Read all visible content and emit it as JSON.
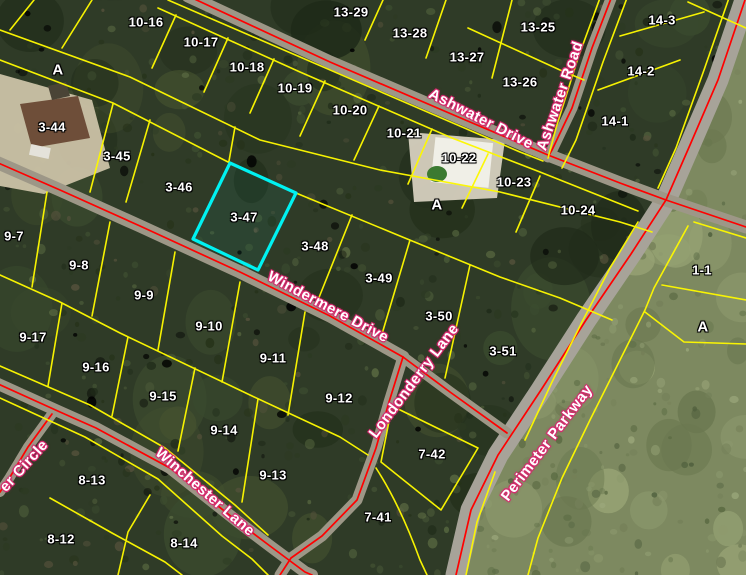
{
  "map_view": {
    "description": "aerial-parcel-map",
    "highlighted_parcel": {
      "id": "3-47"
    },
    "colors": {
      "parcel_line": "#fdf800",
      "highlight_outline": "#00f2f2",
      "road_centerline": "#ff0000",
      "parcel_label_text": "#ffffff",
      "parcel_label_halo": "#000000",
      "street_label_text": "#ffffff",
      "street_label_halo": "#d62a6e",
      "forest_base": "#2f3b27",
      "clearing_base": "#7d8960",
      "road_surface": "#9d9787"
    },
    "parcel_labels": [
      {
        "id": "10-15",
        "x": 105,
        "y": -6
      },
      {
        "id": "10-16",
        "x": 146,
        "y": 22
      },
      {
        "id": "10-17",
        "x": 201,
        "y": 42
      },
      {
        "id": "10-18",
        "x": 247,
        "y": 67
      },
      {
        "id": "10-19",
        "x": 295,
        "y": 88
      },
      {
        "id": "10-20",
        "x": 350,
        "y": 110
      },
      {
        "id": "10-21",
        "x": 404,
        "y": 133
      },
      {
        "id": "10-22",
        "x": 459,
        "y": 158
      },
      {
        "id": "10-23",
        "x": 514,
        "y": 182
      },
      {
        "id": "10-24",
        "x": 578,
        "y": 210
      },
      {
        "id": "13-29",
        "x": 351,
        "y": 12
      },
      {
        "id": "13-28",
        "x": 410,
        "y": 33
      },
      {
        "id": "13-27",
        "x": 467,
        "y": 57
      },
      {
        "id": "13-25",
        "x": 538,
        "y": 27
      },
      {
        "id": "13-26",
        "x": 520,
        "y": 82
      },
      {
        "id": "14-3",
        "x": 662,
        "y": 20
      },
      {
        "id": "14-2",
        "x": 641,
        "y": 71
      },
      {
        "id": "14-1",
        "x": 615,
        "y": 121
      },
      {
        "id": "3-44",
        "x": 52,
        "y": 127
      },
      {
        "id": "3-45",
        "x": 117,
        "y": 156
      },
      {
        "id": "3-46",
        "x": 179,
        "y": 187
      },
      {
        "id": "3-47",
        "x": 244,
        "y": 217
      },
      {
        "id": "3-48",
        "x": 315,
        "y": 246
      },
      {
        "id": "3-49",
        "x": 379,
        "y": 278
      },
      {
        "id": "3-50",
        "x": 439,
        "y": 316
      },
      {
        "id": "3-51",
        "x": 503,
        "y": 351
      },
      {
        "id": "9-7",
        "x": 14,
        "y": 236
      },
      {
        "id": "9-8",
        "x": 79,
        "y": 265
      },
      {
        "id": "9-9",
        "x": 144,
        "y": 295
      },
      {
        "id": "9-10",
        "x": 209,
        "y": 326
      },
      {
        "id": "9-11",
        "x": 273,
        "y": 358
      },
      {
        "id": "9-12",
        "x": 339,
        "y": 398
      },
      {
        "id": "9-17",
        "x": 33,
        "y": 337
      },
      {
        "id": "9-16",
        "x": 96,
        "y": 367
      },
      {
        "id": "9-15",
        "x": 163,
        "y": 396
      },
      {
        "id": "9-14",
        "x": 224,
        "y": 430
      },
      {
        "id": "9-13",
        "x": 273,
        "y": 475
      },
      {
        "id": "8-13",
        "x": 92,
        "y": 480
      },
      {
        "id": "8-12",
        "x": 61,
        "y": 539
      },
      {
        "id": "8-14",
        "x": 184,
        "y": 543
      },
      {
        "id": "7-42",
        "x": 432,
        "y": 454
      },
      {
        "id": "7-41",
        "x": 378,
        "y": 517
      },
      {
        "id": "1-1",
        "x": 702,
        "y": 270
      }
    ],
    "block_labels": [
      {
        "text": "A",
        "x": 58,
        "y": 70
      },
      {
        "text": "A",
        "x": 437,
        "y": 205
      },
      {
        "text": "A",
        "x": 703,
        "y": 327
      }
    ],
    "street_labels": [
      {
        "name": "Ashwater Drive",
        "x": 481,
        "y": 119,
        "angle": 27
      },
      {
        "name": "Ashwater Road",
        "x": 560,
        "y": 96,
        "angle": -71
      },
      {
        "name": "Windermere Drive",
        "x": 328,
        "y": 307,
        "angle": 28
      },
      {
        "name": "Londonderry Lane",
        "x": 414,
        "y": 381,
        "angle": -53
      },
      {
        "name": "Winchester Lane",
        "x": 205,
        "y": 492,
        "angle": 41
      },
      {
        "name": "Perimeter Parkway",
        "x": 547,
        "y": 443,
        "angle": -53
      },
      {
        "name": "er Circle",
        "x": 24,
        "y": 466,
        "angle": -48
      }
    ]
  }
}
